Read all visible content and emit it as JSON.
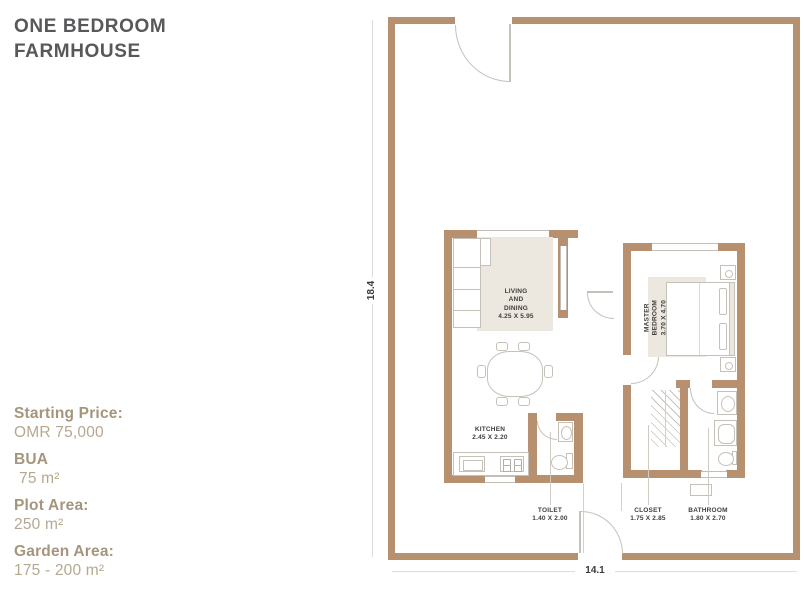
{
  "title": {
    "line1": "ONE BEDROOM",
    "line2": "FARMHOUSE"
  },
  "details": [
    {
      "label": "Starting Price:",
      "value": "OMR 75,000"
    },
    {
      "label": "BUA",
      "value": "75 m²"
    },
    {
      "label": "Plot Area:",
      "value": "250 m²"
    },
    {
      "label": "Garden Area:",
      "value": "175 - 200 m²"
    }
  ],
  "floor_plan": {
    "plot_dimensions": {
      "height": "18.4",
      "width": "14.1"
    },
    "rooms": [
      {
        "id": "living-dining",
        "name": "LIVING\nAND\nDINING",
        "size": "4.25 X 5.95"
      },
      {
        "id": "master-bedroom",
        "name": "MASTER BEDROOM",
        "size": "3.70 X 4.70"
      },
      {
        "id": "kitchen",
        "name": "KITCHEN",
        "size": "2.45 X 2.20"
      },
      {
        "id": "toilet",
        "name": "TOILET",
        "size": "1.40 X 2.00"
      },
      {
        "id": "closet",
        "name": "CLOSET",
        "size": "1.75 X 2.85"
      },
      {
        "id": "bathroom",
        "name": "BATHROOM",
        "size": "1.80 X 2.70"
      }
    ],
    "colors": {
      "wall": "#b7916f",
      "fixture_line": "#c6c1b8",
      "rug": "#ece7df",
      "room_label_text": "#3e3e3e",
      "dimension_text": "#3a3a3a",
      "accent_text": "#a5957d",
      "title_text": "#57585a"
    }
  }
}
